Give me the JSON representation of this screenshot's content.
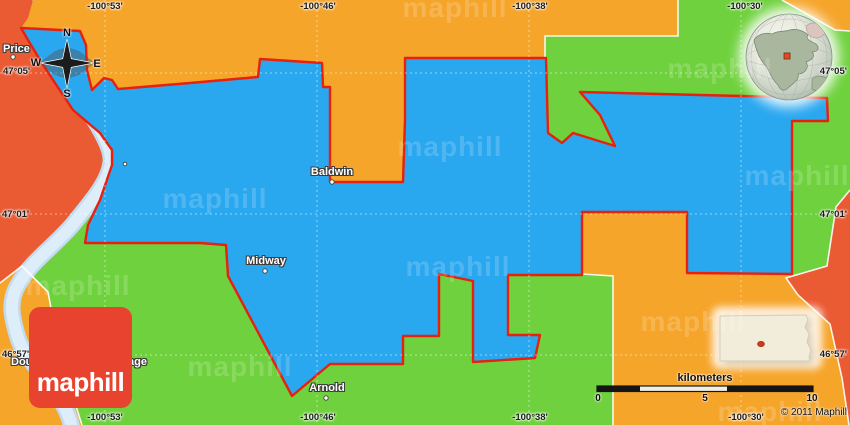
{
  "map": {
    "title": "Political simple map of the Baldwin area (Maphill)",
    "places": {
      "price": "Price",
      "baldwin": "Baldwin",
      "midway": "Midway",
      "arnold": "Arnold",
      "village_fragment_left": "Dou",
      "village_fragment_right": "age"
    },
    "grid": {
      "lon_labels": [
        "-100°53'",
        "-100°46'",
        "-100°38'",
        "-100°30'"
      ],
      "lat_labels": [
        "47°05'",
        "47°01'",
        "46°57'"
      ]
    },
    "compass": {
      "n": "N",
      "w": "W",
      "e": "E",
      "s": "S"
    },
    "scale_bar": {
      "unit_label": "kilometers",
      "ticks": [
        "0",
        "5",
        "10"
      ]
    },
    "copyright": "© 2011 Maphill",
    "logo_text": "maphill",
    "watermark_text": "maphill",
    "colors": {
      "highlight_blue": "#29a7ef",
      "green": "#6fd13d",
      "orange": "#f6a52b",
      "salmon": "#ea5a33",
      "border_red": "#e8200c",
      "river": "#ddedf9",
      "logo_red": "#e8432f",
      "inset_state_fill": "#f2ecda"
    }
  }
}
